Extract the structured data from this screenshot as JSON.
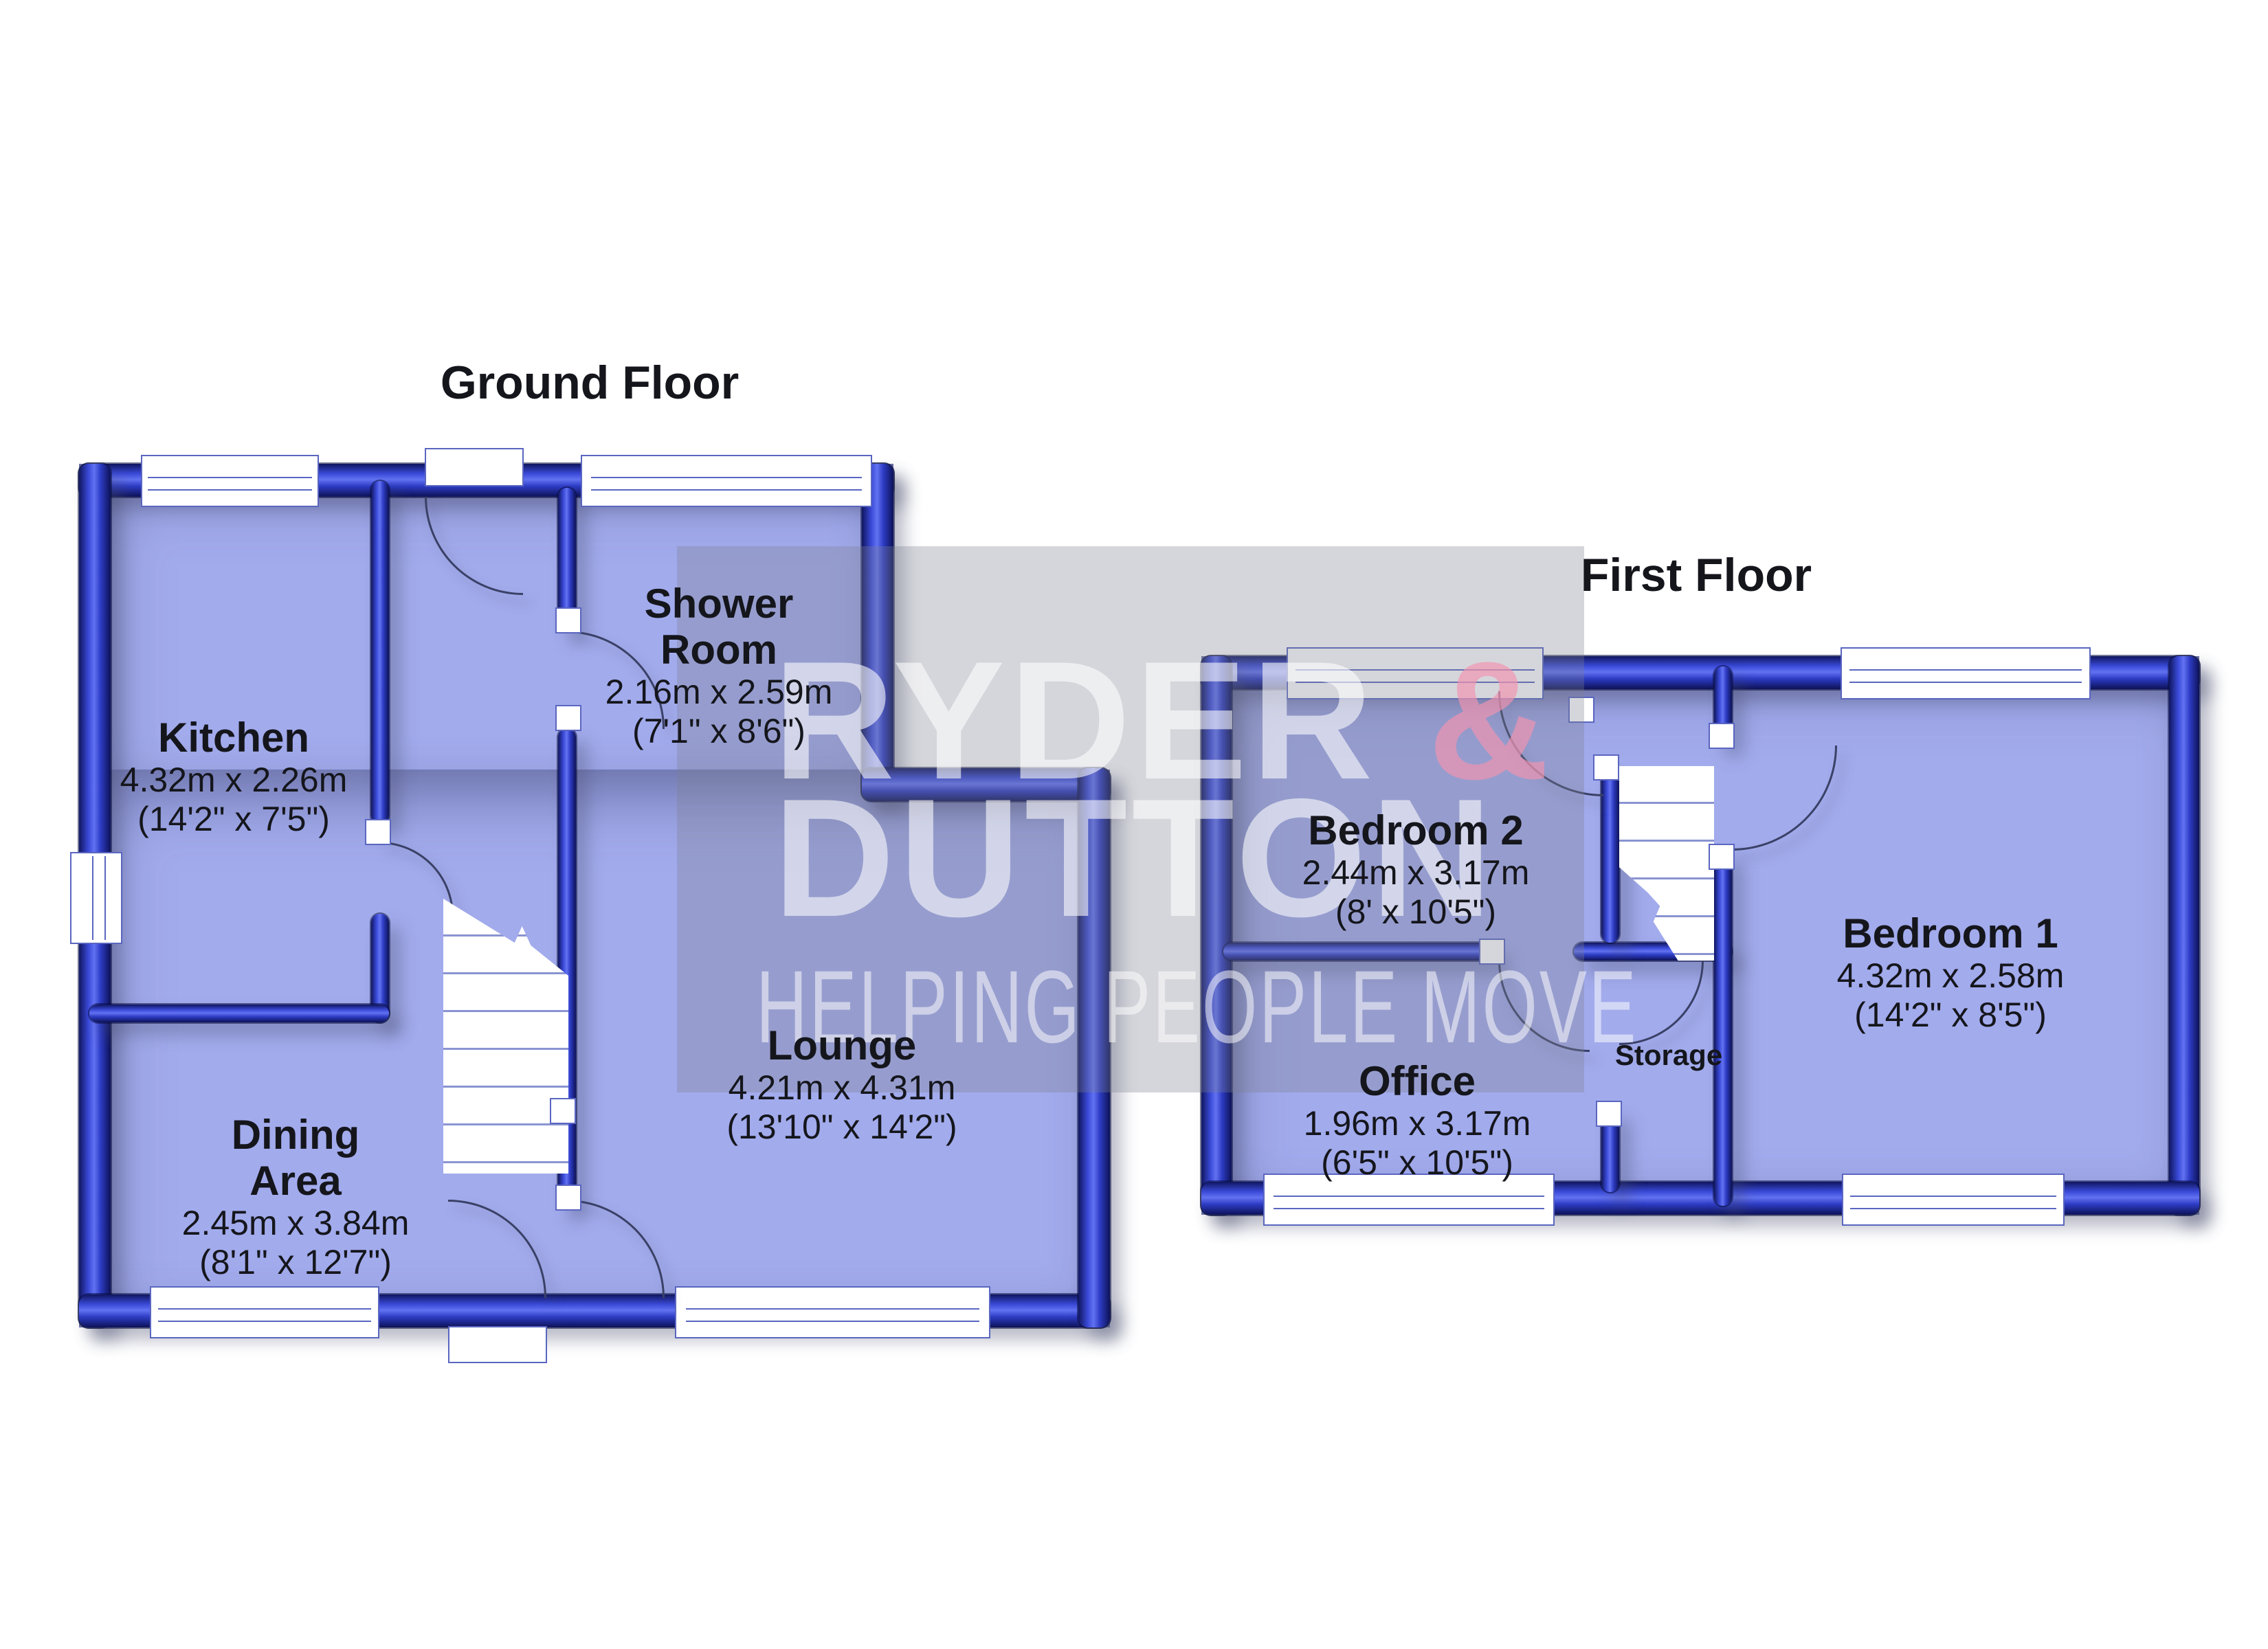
{
  "titles": {
    "ground": "Ground Floor",
    "first": "First Floor"
  },
  "watermark": {
    "brand_line1": "RYDER ",
    "brand_amp": "&",
    "brand_line2": "DUTTON",
    "tagline": "HELPING PEOPLE MOVE"
  },
  "colors": {
    "room_fill": "#a2abec",
    "wall_blue": "#2d3cc4",
    "wall_dark": "#10165f",
    "watermark_overlay": "rgba(124,128,142,0.32)",
    "watermark_text": "rgba(255,255,255,0.58)",
    "watermark_amp": "rgba(242,148,175,0.68)",
    "label_text": "#15161c",
    "background": "#ffffff"
  },
  "rooms": {
    "kitchen": {
      "name": "Kitchen",
      "metric": "4.32m x 2.26m",
      "imperial": "(14'2\" x 7'5\")"
    },
    "shower": {
      "name_line1": "Shower",
      "name_line2": "Room",
      "metric": "2.16m x 2.59m",
      "imperial": "(7'1\" x 8'6\")"
    },
    "lounge": {
      "name": "Lounge",
      "metric": "4.21m x 4.31m",
      "imperial": "(13'10\" x 14'2\")"
    },
    "dining": {
      "name_line1": "Dining",
      "name_line2": "Area",
      "metric": "2.45m x 3.84m",
      "imperial": "(8'1\" x 12'7\")"
    },
    "bedroom2": {
      "name": "Bedroom 2",
      "metric": "2.44m x 3.17m",
      "imperial": "(8' x 10'5\")"
    },
    "bedroom1": {
      "name": "Bedroom 1",
      "metric": "4.32m x 2.58m",
      "imperial": "(14'2\" x 8'5\")"
    },
    "office": {
      "name": "Office",
      "metric": "1.96m x 3.17m",
      "imperial": "(6'5\" x 10'5\")"
    },
    "storage": {
      "name": "Storage"
    }
  }
}
